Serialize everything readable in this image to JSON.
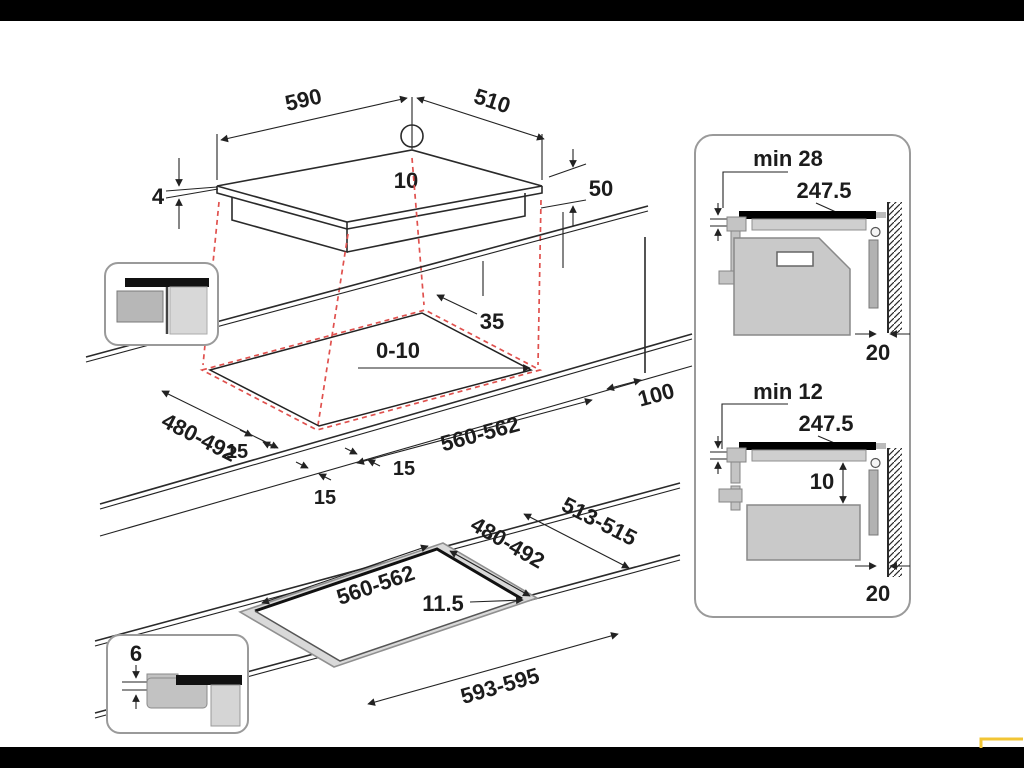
{
  "colors": {
    "projection_red": "#e0514e",
    "highlight_yellow": "#f2c535",
    "line": "#222222",
    "oven_gray": "#c9c9c9",
    "ledge_gray": "#d9d9d9"
  },
  "hob_view": {
    "width_mm": "590",
    "depth_mm": "510",
    "rear_hole_offset_mm": "10",
    "glass_thickness_mm": "4",
    "body_height_mm": "50"
  },
  "cutout_view": {
    "corner_detail_mm": "35",
    "back_edge_gap_mm": "0-10",
    "depth_range_mm": "480-492",
    "front_margin_left_mm": "15",
    "front_margin_mid_mm": "15",
    "front_margin_right_mm": "15",
    "width_range_mm": "560-562",
    "right_clearance_mm": "100"
  },
  "flush_view": {
    "outer_depth_mm": "513-515",
    "depth_range_mm": "480-492",
    "width_range_mm": "560-562",
    "rebate_width_mm": "11.5",
    "outer_width_mm": "593-595",
    "recess_depth_mm": "6"
  },
  "clearances": {
    "oven_under": {
      "min_gap": "min 28",
      "hob_depth_mm": "247.5",
      "rear_gap_mm": "20"
    },
    "drawer_under": {
      "min_gap": "min 12",
      "hob_depth_mm": "247.5",
      "gap_below_mm": "10",
      "rear_gap_mm": "20"
    }
  }
}
